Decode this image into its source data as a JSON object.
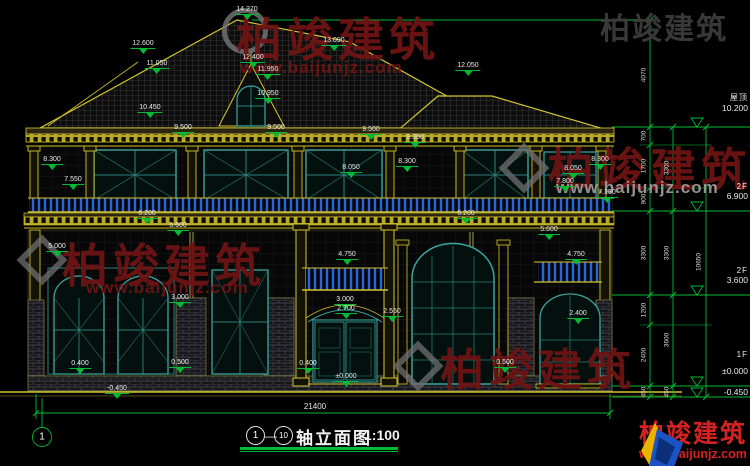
{
  "drawing": {
    "marks": [
      "14.270",
      "12.600",
      "11.050",
      "12.400",
      "11.950",
      "13.090",
      "12.050",
      "10.950",
      "10.450",
      "9.500",
      "9.500",
      "9.500",
      "9.300",
      "8.300",
      "7.550",
      "8.050",
      "8.300",
      "8.300",
      "8.050",
      "7.800",
      "7.150",
      "6.200",
      "5.600",
      "6.200",
      "5.600",
      "5.000",
      "4.750",
      "4.750",
      "3.000",
      "3.000",
      "2.700",
      "2.550",
      "2.400",
      "0.500",
      "0.400",
      "0.400",
      "-0.450",
      "0.500",
      "±0.000"
    ],
    "chain_inner": [
      "4070",
      "700",
      "1700",
      "900",
      "3300",
      "1200",
      "2400",
      "450"
    ],
    "chain_mid": [
      "3300",
      "3300",
      "3600",
      "450"
    ],
    "chain_outer": [
      "10650"
    ],
    "levels": [
      {
        "label": "屋顶",
        "value": "10.200"
      },
      {
        "label": "2F",
        "value": "6.900"
      },
      {
        "label": "2F",
        "value": "3.600"
      },
      {
        "label": "1F",
        "value": "±0.000"
      },
      {
        "label": "",
        "value": "-0.450"
      }
    ],
    "width_dim": "21400",
    "axis_bubble": "1",
    "title": {
      "axis_start": "1",
      "axis_end": "10",
      "name": "轴立面图",
      "scale": "1:100"
    }
  },
  "watermark": {
    "brand": "柏竣建筑",
    "site": "www.baijunjz.com"
  },
  "logo": {
    "brand": "柏竣建筑",
    "site": "www.baijunjz.com"
  }
}
